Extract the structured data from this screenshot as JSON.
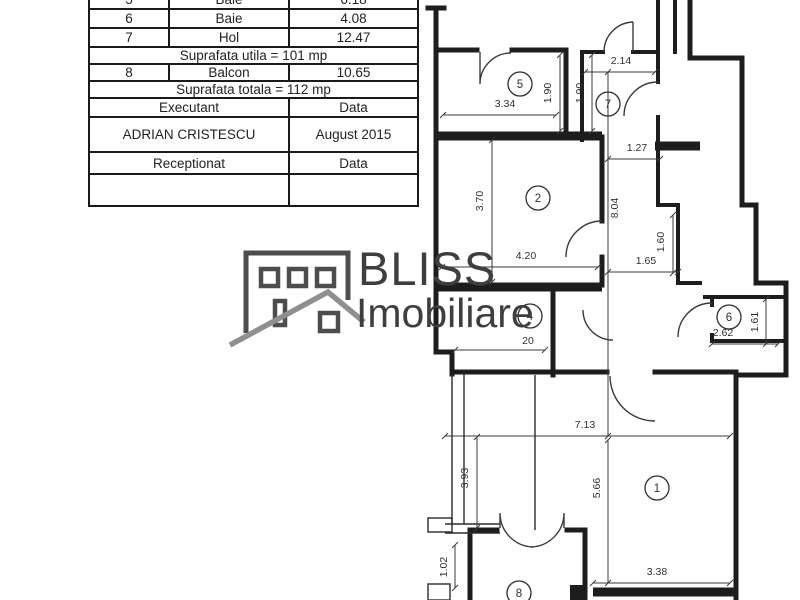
{
  "table": {
    "rooms": [
      {
        "no": "5",
        "name": "Baie",
        "area": "6.18"
      },
      {
        "no": "6",
        "name": "Baie",
        "area": "4.08"
      },
      {
        "no": "7",
        "name": "Hol",
        "area": "12.47"
      }
    ],
    "suprafata_utila": "Suprafata utila = 101 mp",
    "balcon_row": {
      "no": "8",
      "name": "Balcon",
      "area": "10.65"
    },
    "suprafata_totala": "Suprafata totala = 112 mp",
    "executant_label": "Executant",
    "executant_data_label": "Data",
    "executant_name": "ADRIAN CRISTESCU",
    "date_value": "August 2015",
    "receptionat_label": "Receptionat",
    "receptionat_data_label": "Data"
  },
  "logo": {
    "name": "BLISS",
    "subtitle": "Imobiliare",
    "icon_color": "#4d4d4d",
    "roof_color": "#8f8f8f"
  },
  "floorplan": {
    "line_color": "#1d1d1d",
    "rooms": [
      {
        "n": "1",
        "cx": 657,
        "cy": 488
      },
      {
        "n": "2",
        "cx": 538,
        "cy": 198
      },
      {
        "n": "4",
        "cx": 530,
        "cy": 316
      },
      {
        "n": "5",
        "cx": 520,
        "cy": 84
      },
      {
        "n": "6",
        "cx": 729,
        "cy": 317
      },
      {
        "n": "7",
        "cx": 608,
        "cy": 104
      },
      {
        "n": "8",
        "cx": 519,
        "cy": 593
      }
    ],
    "dims": [
      {
        "t": "3.34",
        "x1": 443,
        "y1": 115,
        "x2": 556,
        "y2": 115,
        "tx": 505,
        "ty": 107,
        "r": 0
      },
      {
        "t": "1.90",
        "x1": 560,
        "y1": 55,
        "x2": 560,
        "y2": 131,
        "tx": 551,
        "ty": 93,
        "r": -90
      },
      {
        "t": "1.90",
        "x1": 592,
        "y1": 55,
        "x2": 592,
        "y2": 131,
        "tx": 583,
        "ty": 93,
        "r": -90
      },
      {
        "t": "2.14",
        "x1": 585,
        "y1": 72,
        "x2": 655,
        "y2": 72,
        "tx": 621,
        "ty": 64,
        "r": 0
      },
      {
        "t": "1.27",
        "x1": 608,
        "y1": 159,
        "x2": 660,
        "y2": 159,
        "tx": 637,
        "ty": 151,
        "r": 0
      },
      {
        "t": "3.70",
        "x1": 492,
        "y1": 140,
        "x2": 492,
        "y2": 282,
        "tx": 483,
        "ty": 201,
        "r": -90
      },
      {
        "t": "4.20",
        "x1": 442,
        "y1": 267,
        "x2": 598,
        "y2": 267,
        "tx": 526,
        "ty": 259,
        "r": 0
      },
      {
        "t": "8.04",
        "x1": 608,
        "y1": 72,
        "x2": 608,
        "y2": 436,
        "tx": 618,
        "ty": 208,
        "r": -90
      },
      {
        "t": "1.65",
        "x1": 608,
        "y1": 272,
        "x2": 678,
        "y2": 272,
        "tx": 646,
        "ty": 264,
        "r": 0
      },
      {
        "t": "1.60",
        "x1": 673,
        "y1": 215,
        "x2": 673,
        "y2": 273,
        "tx": 664,
        "ty": 242,
        "r": -90
      },
      {
        "t": "2.62",
        "x1": 712,
        "y1": 344,
        "x2": 778,
        "y2": 344,
        "tx": 723,
        "ty": 336,
        "r": 0
      },
      {
        "t": "1.61",
        "x1": 766,
        "y1": 299,
        "x2": 766,
        "y2": 344,
        "tx": 758,
        "ty": 322,
        "r": -90
      },
      {
        "t": "7.13",
        "x1": 445,
        "y1": 436,
        "x2": 730,
        "y2": 436,
        "tx": 585,
        "ty": 428,
        "r": 0
      },
      {
        "t": "3.93",
        "x1": 477,
        "y1": 437,
        "x2": 477,
        "y2": 528,
        "tx": 468,
        "ty": 478,
        "r": -90
      },
      {
        "t": "5.66",
        "x1": 608,
        "y1": 440,
        "x2": 608,
        "y2": 583,
        "tx": 600,
        "ty": 488,
        "r": -90
      },
      {
        "t": "1.02",
        "x1": 455,
        "y1": 545,
        "x2": 455,
        "y2": 588,
        "tx": 447,
        "ty": 567,
        "r": -90
      },
      {
        "t": "3.38",
        "x1": 593,
        "y1": 583,
        "x2": 730,
        "y2": 583,
        "tx": 657,
        "ty": 575,
        "r": 0
      },
      {
        "t": "20",
        "x1": 455,
        "y1": 350,
        "x2": 545,
        "y2": 350,
        "tx": 528,
        "ty": 344,
        "r": 0
      }
    ]
  }
}
